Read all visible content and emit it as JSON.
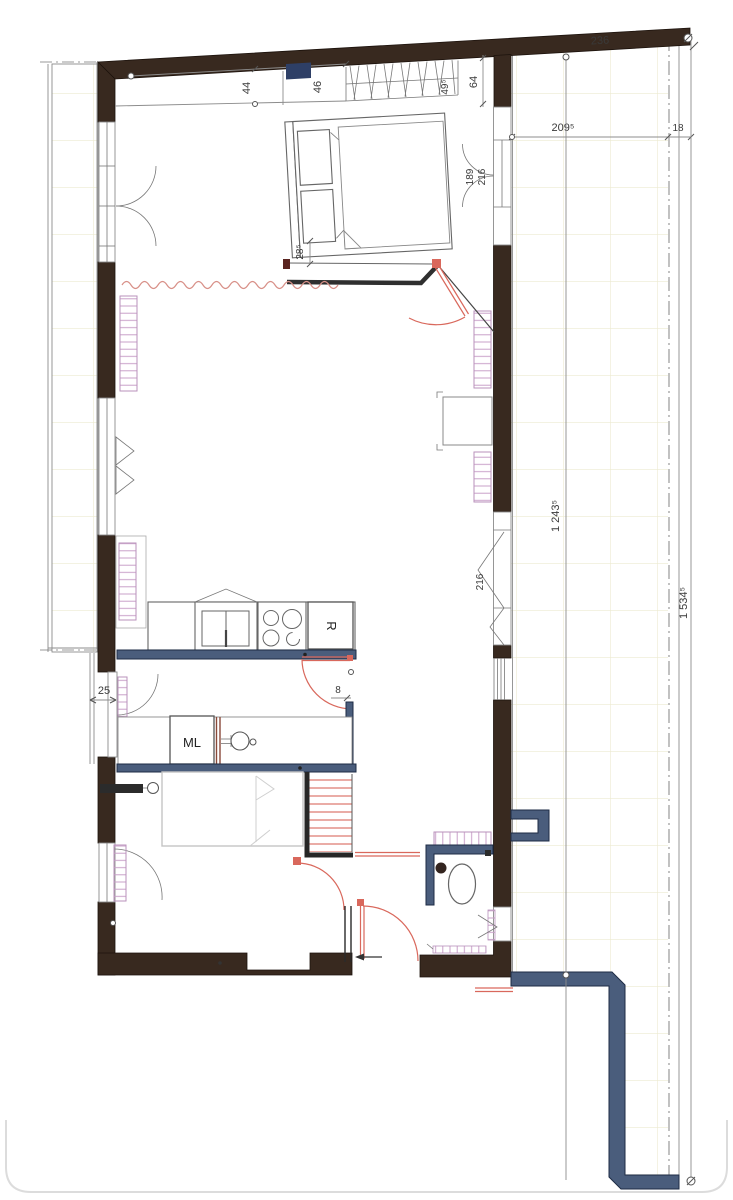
{
  "plan": {
    "title_hint": "apartment floor plan with terrace",
    "dims": {
      "top_wall": "236",
      "closet_left": "44",
      "closet_mid": "46",
      "closet_width": "49⁵",
      "closet_depth": "64",
      "bed_offset": "28⁵",
      "bedroom_door_a": "189",
      "bedroom_door_b": "216",
      "terrace_width": "209⁵",
      "terrace_edge": "18",
      "terrace_inner_length": "1 243⁵",
      "terrace_outer_length": "1 534⁵",
      "right_window": "216",
      "left_wall_offset": "25",
      "kitchen_partition": "8"
    },
    "labels": {
      "washing_machine": "ML",
      "fridge": "R"
    },
    "colors": {
      "wall_dark": "#38291f",
      "new_wall_blue": "#4a5d7c",
      "door_red": "#d9685c",
      "radiator_pink": "#c9a0c9",
      "terrace_grid": "#ecead0",
      "navy_marker": "#2e3f66",
      "line_gray": "#8c8c8c",
      "bed_gray": "#c4c4c4",
      "text": "#3a3a3a"
    }
  }
}
